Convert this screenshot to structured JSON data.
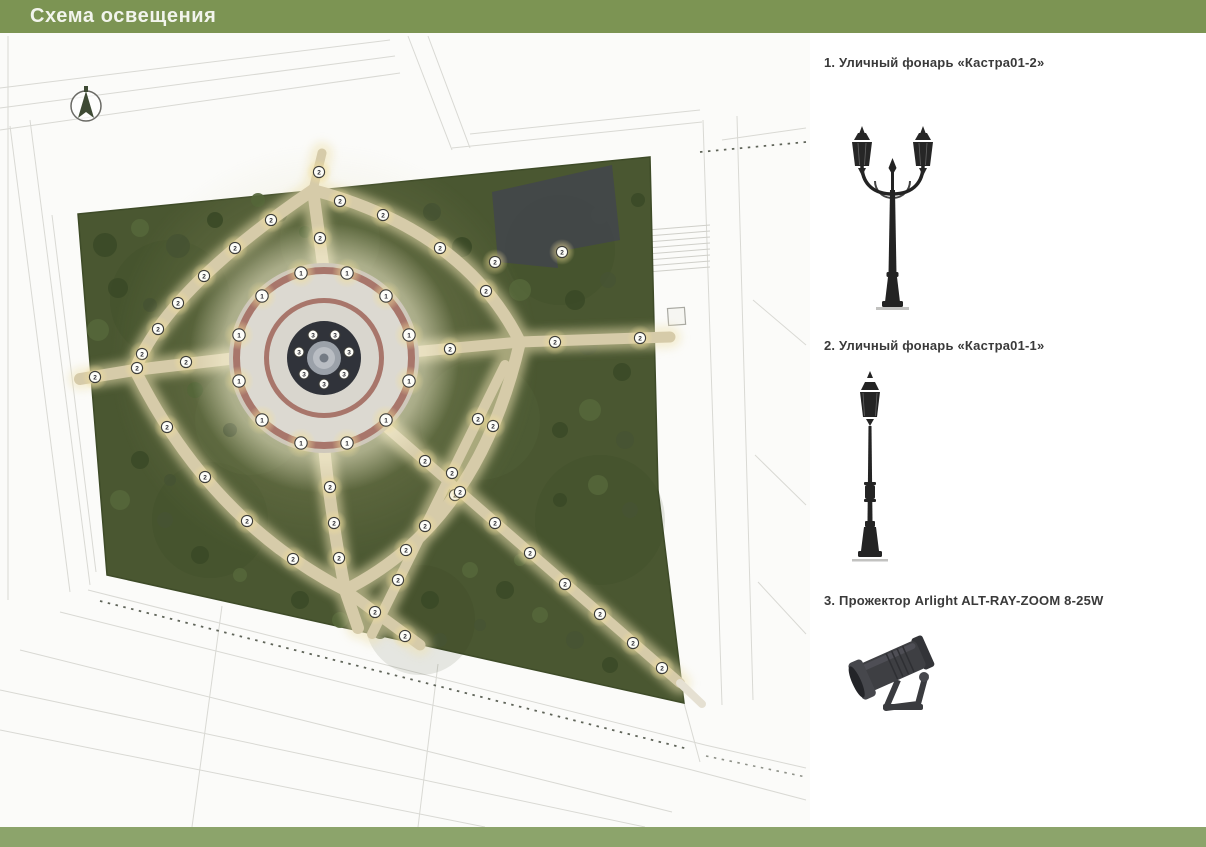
{
  "header": {
    "title": "Схема освещения"
  },
  "colors": {
    "header_green": "#7C9453",
    "footer_green": "#8CA46B",
    "park_green": "#4A5731",
    "path_tan": "#D6CBA9",
    "plaza_ring_brown": "#A8766B",
    "plaza_light": "#DCD9D1",
    "lamp_glow_yellow": "#F2DF9A"
  },
  "legend": {
    "items": [
      {
        "label": "1. Уличный фонарь «Кастра01-2»",
        "icon": "double-street-lamp-icon"
      },
      {
        "label": "2. Уличный фонарь «Кастра01-1»",
        "icon": "single-street-lamp-icon"
      },
      {
        "label": "3. Прожектор Arlight ALT-RAY-ZOOM 8-25W",
        "icon": "floodlight-icon"
      }
    ]
  },
  "map": {
    "north_arrow": "compass-north",
    "lamps": {
      "type1": [
        [
          409,
          381
        ],
        [
          386,
          420
        ],
        [
          347,
          443
        ],
        [
          301,
          443
        ],
        [
          262,
          420
        ],
        [
          239,
          381
        ],
        [
          239,
          335
        ],
        [
          262,
          296
        ],
        [
          301,
          273
        ],
        [
          347,
          273
        ],
        [
          386,
          296
        ],
        [
          409,
          335
        ]
      ],
      "type2": [
        [
          271,
          220
        ],
        [
          235,
          248
        ],
        [
          204,
          276
        ],
        [
          178,
          303
        ],
        [
          158,
          329
        ],
        [
          142,
          354
        ],
        [
          137,
          368
        ],
        [
          167,
          427
        ],
        [
          205,
          477
        ],
        [
          247,
          521
        ],
        [
          293,
          559
        ],
        [
          406,
          550
        ],
        [
          455,
          495
        ],
        [
          493,
          426
        ],
        [
          486,
          291
        ],
        [
          440,
          248
        ],
        [
          383,
          215
        ],
        [
          340,
          201
        ],
        [
          320,
          238
        ],
        [
          186,
          362
        ],
        [
          95,
          377
        ],
        [
          330,
          487
        ],
        [
          334,
          523
        ],
        [
          339,
          558
        ],
        [
          450,
          349
        ],
        [
          555,
          342
        ],
        [
          640,
          338
        ],
        [
          425,
          461
        ],
        [
          460,
          492
        ],
        [
          495,
          523
        ],
        [
          530,
          553
        ],
        [
          565,
          584
        ],
        [
          600,
          614
        ],
        [
          633,
          643
        ],
        [
          662,
          668
        ],
        [
          478,
          419
        ],
        [
          452,
          473
        ],
        [
          425,
          526
        ],
        [
          398,
          580
        ],
        [
          375,
          612
        ],
        [
          405,
          636
        ],
        [
          319,
          172
        ],
        [
          495,
          262
        ],
        [
          562,
          252
        ]
      ],
      "type3": [
        [
          324,
          384
        ],
        [
          304,
          374
        ],
        [
          299,
          352
        ],
        [
          313,
          335
        ],
        [
          335,
          335
        ],
        [
          349,
          352
        ],
        [
          344,
          374
        ]
      ]
    }
  }
}
